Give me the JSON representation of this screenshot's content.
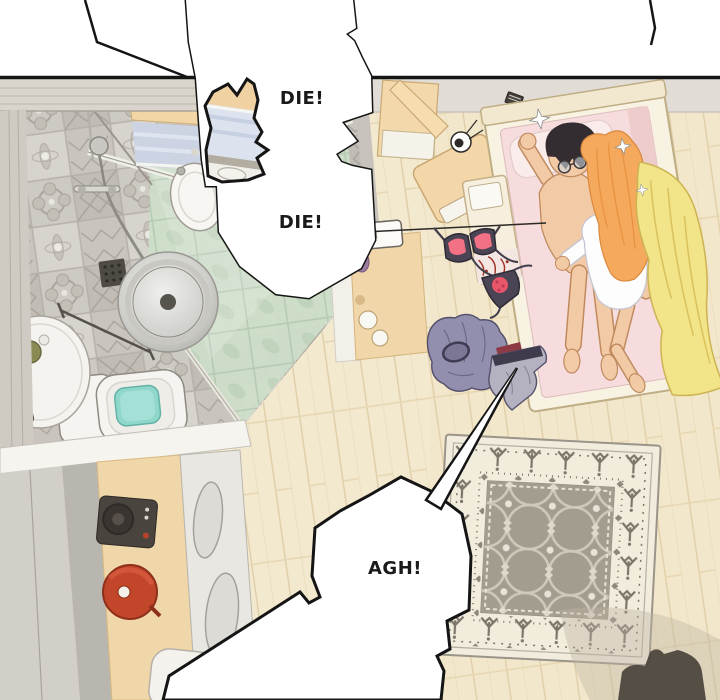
{
  "panel": {
    "kind": "webtoon-comic-panel",
    "bubbles": {
      "die1": {
        "text": "DIE!"
      },
      "die2": {
        "text": "DIE!"
      },
      "agh": {
        "text": "AGH!"
      }
    },
    "scene": {
      "rooms": [
        "bathroom",
        "bedroom",
        "kitchen",
        "hallway"
      ],
      "objects": [
        "shower-glass",
        "floor-drain",
        "washer-drum",
        "bathroom-sink",
        "vanity-window",
        "toilet",
        "side-table",
        "top-wall",
        "wardrobe",
        "dresser-lamp",
        "bed",
        "sleeping-couple",
        "yellow-blanket",
        "pillow",
        "nightstand",
        "hanging-bra",
        "panties",
        "clothes-pile",
        "patterned-rug",
        "cooktop",
        "red-pot",
        "kitchen-sink",
        "floor-shadow"
      ]
    },
    "colors": {
      "bubble_fill": "#ffffff",
      "bubble_outline": "#151515",
      "text": "#1a1a1a",
      "wall_grey": "#e0dcd5",
      "plank_wall": "#d9d4cb",
      "tile_base": "#cbc7c0",
      "wood_floor": "#f3e9cf",
      "shower_green": "#cddec9",
      "water_teal": "#8fd6cb",
      "counter_tan": "#f2d6a6",
      "window_blue": "#ccd4e4",
      "bed_frame_cream": "#f8f2e2",
      "mattress_pink": "#f6dcdc",
      "blanket_yellow": "#f2e488",
      "hair_black": "#332c31",
      "hair_orange": "#f4a95c",
      "skin": "#f2cba6",
      "shirt_white": "#fdfdfd",
      "rug_cream": "#f1ecdc",
      "rug_field_grey": "#a39d90",
      "rug_motif_grey": "#7b7669",
      "bra_dark": "#4a4455",
      "bra_pink": "#f27184",
      "pot_red": "#c1462a",
      "clothes_purple": "#928fae"
    }
  }
}
